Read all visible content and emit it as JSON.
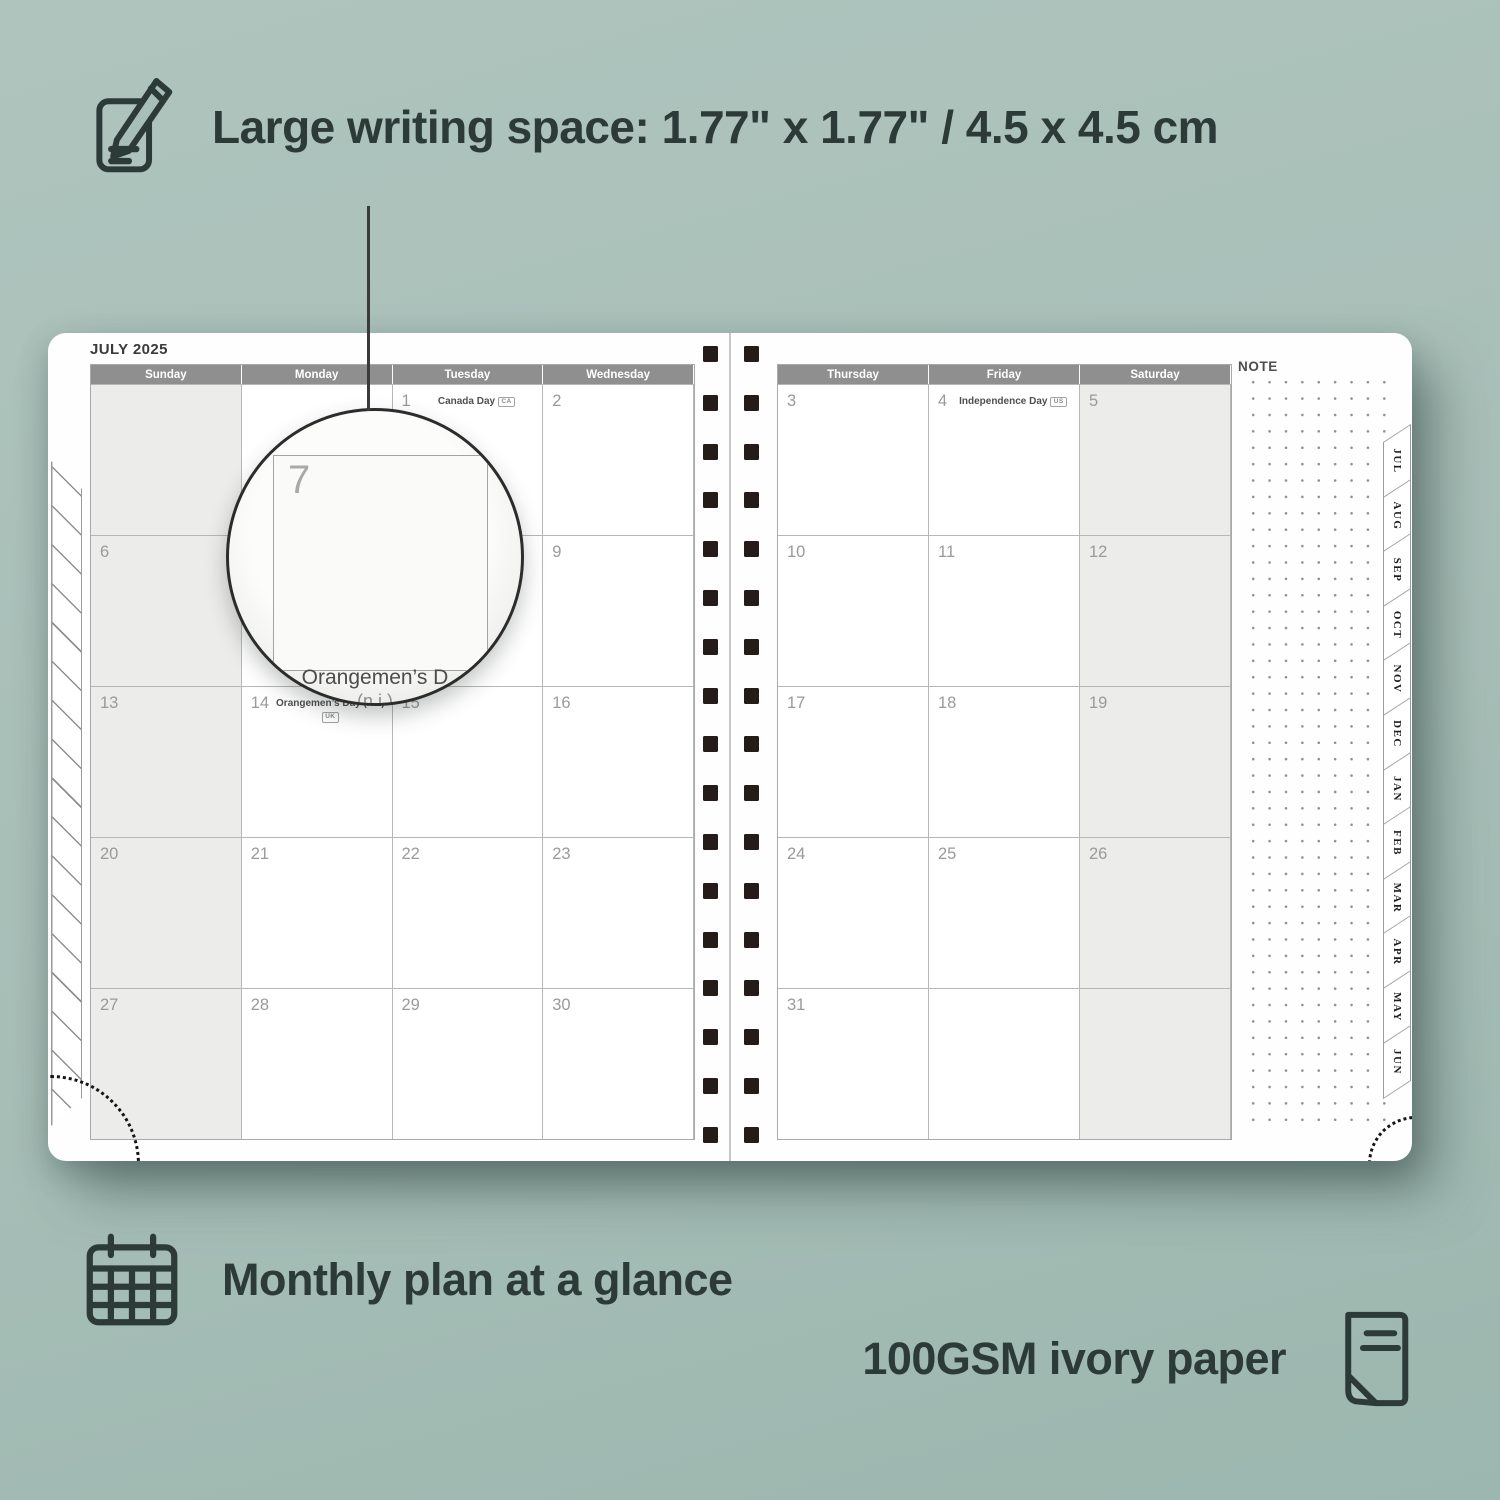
{
  "colors": {
    "background": "#a8bfb8",
    "accent_dark": "#2d3b38",
    "header_bar": "#8f8f8f",
    "shaded_cell": "#ececea",
    "binding_square": "#251c19"
  },
  "features": {
    "writing_space": {
      "icon": "note-pencil-icon",
      "label": "Large writing space: 1.77\" x 1.77\" / 4.5 x 4.5 cm"
    },
    "monthly_plan": {
      "icon": "calendar-grid-icon",
      "label": "Monthly plan at a glance"
    },
    "paper": {
      "icon": "paper-sheet-icon",
      "label": "100GSM ivory paper"
    }
  },
  "planner": {
    "month_title": "JULY 2025",
    "note_label": "NOTE",
    "left_page_headers": [
      "Sunday",
      "Monday",
      "Tuesday",
      "Wednesday"
    ],
    "right_page_headers": [
      "Thursday",
      "Friday",
      "Saturday"
    ],
    "month_tabs": [
      "JUL",
      "AUG",
      "SEP",
      "OCT",
      "NOV",
      "DEC",
      "JAN",
      "FEB",
      "MAR",
      "APR",
      "MAY",
      "JUN"
    ],
    "left_cells": [
      [
        {
          "day": "",
          "shaded": true
        },
        {
          "day": ""
        },
        {
          "day": "1",
          "holiday": "Canada Day",
          "badge": "CA"
        },
        {
          "day": "2"
        }
      ],
      [
        {
          "day": "6",
          "shaded": true
        },
        {
          "day": "7"
        },
        {
          "day": "8"
        },
        {
          "day": "9"
        }
      ],
      [
        {
          "day": "13",
          "shaded": true
        },
        {
          "day": "14",
          "holiday": "Orangemen’s Day (n.i.)",
          "badge": "UK"
        },
        {
          "day": "15"
        },
        {
          "day": "16"
        }
      ],
      [
        {
          "day": "20",
          "shaded": true
        },
        {
          "day": "21"
        },
        {
          "day": "22"
        },
        {
          "day": "23"
        }
      ],
      [
        {
          "day": "27",
          "shaded": true
        },
        {
          "day": "28"
        },
        {
          "day": "29"
        },
        {
          "day": "30"
        }
      ]
    ],
    "right_cells": [
      [
        {
          "day": "3"
        },
        {
          "day": "4",
          "holiday": "Independence Day",
          "badge": "US"
        },
        {
          "day": "5",
          "shaded": true
        }
      ],
      [
        {
          "day": "10"
        },
        {
          "day": "11"
        },
        {
          "day": "12",
          "shaded": true
        }
      ],
      [
        {
          "day": "17"
        },
        {
          "day": "18"
        },
        {
          "day": "19",
          "shaded": true
        }
      ],
      [
        {
          "day": "24"
        },
        {
          "day": "25"
        },
        {
          "day": "26",
          "shaded": true
        }
      ],
      [
        {
          "day": "31"
        },
        {
          "day": ""
        },
        {
          "day": "",
          "shaded": true
        }
      ]
    ],
    "magnifier": {
      "day": "7",
      "magnified_holiday": "Orangemen’s D",
      "magnified_holiday_2": "(n.i.)"
    }
  }
}
